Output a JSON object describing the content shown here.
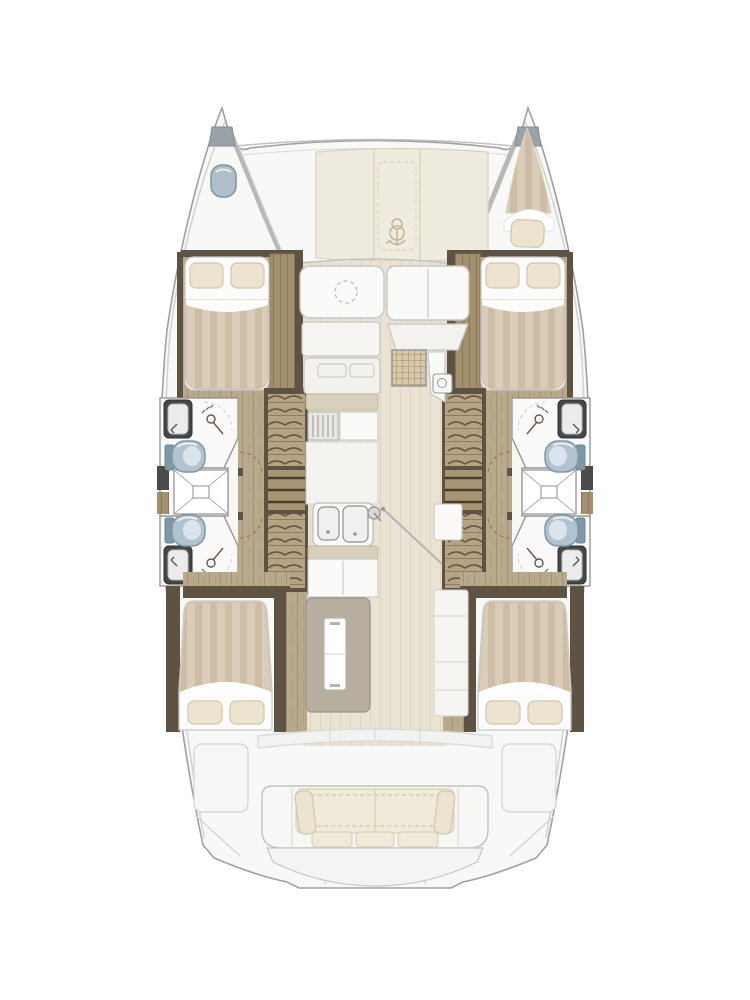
{
  "page": {
    "type": "yacht-floor-plan",
    "subject": "catamaran-deck-and-interior-layout",
    "view": "top-down",
    "visible_text": []
  },
  "vessel": {
    "hulls": 2,
    "cabins": 4,
    "heads": 4,
    "rooms": [
      "port-forward-cabin",
      "starboard-forward-cabin",
      "port-aft-cabin",
      "starboard-aft-cabin",
      "port-forward-head",
      "port-aft-head",
      "port-shower",
      "starboard-forward-head",
      "starboard-aft-head",
      "starboard-shower",
      "salon-galley",
      "forward-cockpit",
      "foredeck-lounge",
      "aft-cockpit"
    ],
    "fixtures": [
      "double-berth x4",
      "bow-berth",
      "toilet x4",
      "washbasin x4",
      "shower-stall x2",
      "galley-double-sink",
      "galley-island",
      "companionway-stairs x2",
      "cockpit-bench",
      "windlass",
      "bow-hatch"
    ]
  },
  "icons": [
    "anchor-windlass-icon",
    "bow-hatch-icon",
    "toilet-icon",
    "sink-icon",
    "shower-mixer-icon",
    "table-circle-icon",
    "faucet-icon"
  ],
  "colors": {
    "deck": "#f8f8f7",
    "outline": "#a0a0a0",
    "softline": "#d2d2d2",
    "innerline": "#c2c2c2",
    "cream": "#f0ebdf",
    "cream_line": "#dcd3bd",
    "wood": "#b9a98c",
    "wood_line": "#a3916f",
    "dark_wood": "#5e5242",
    "wardrobe": "#a3906f",
    "wardrobe_line": "#8a7757",
    "stair": "#b4a384",
    "stair_line": "#6b5a42",
    "floor": "#eae3d4",
    "floor_line": "#ded6c3",
    "duvet_a": "#d9cdb9",
    "duvet_b": "#ccbda4",
    "bed_white": "#fcfcfc",
    "pillow": "#ece3d1",
    "pillow_line": "#d2c7af",
    "toilet": "#b2c2cf",
    "toilet_dark": "#7f98a8",
    "toilet_light": "#dbe4ea",
    "vanity": "#474747",
    "fixture": "#fafaf8",
    "fix_line": "#c6c6c6",
    "beige": "#d9d0bc",
    "beige_line": "#c4b9a2",
    "island": "#b7aea0",
    "island_line": "#9a9388",
    "cushion": "#f0ead9",
    "cushion_line": "#d9d1bb",
    "woven": "#d8c9ac",
    "woven_line": "#b5a07c",
    "bow_cap": "#9aa2a8",
    "hatch": "#aebfc9",
    "hatch_line": "#7f929e",
    "room": "#fafafa",
    "wall": "#8f8f8f"
  }
}
